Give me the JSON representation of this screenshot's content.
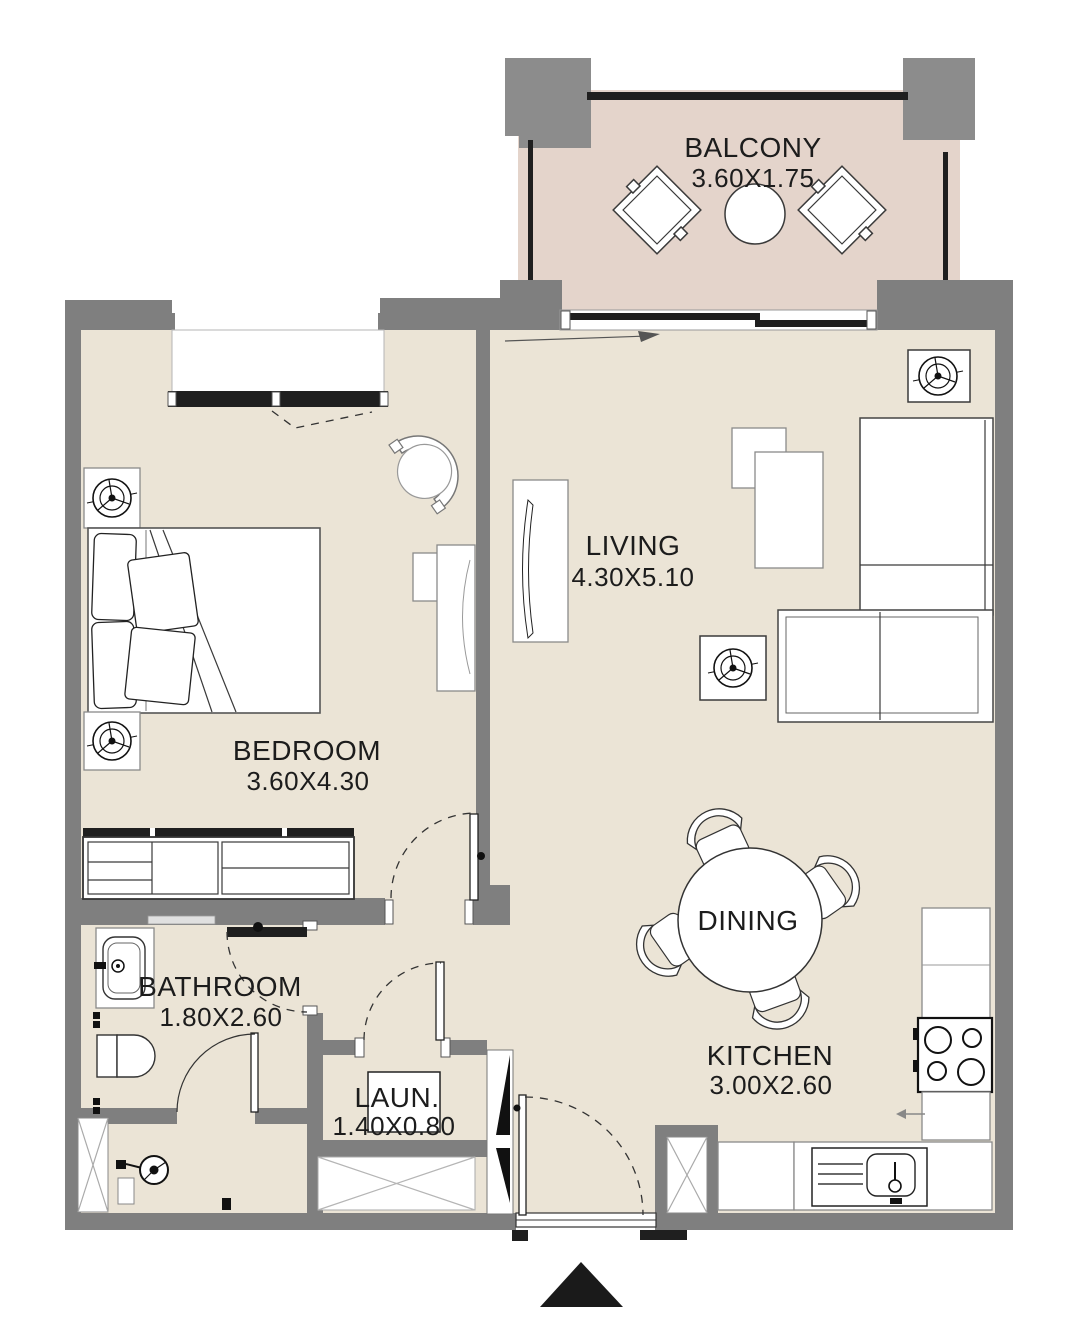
{
  "rooms": {
    "balcony": {
      "name": "BALCONY",
      "dims": "3.60X1.75"
    },
    "living": {
      "name": "LIVING",
      "dims": "4.30X5.10"
    },
    "bedroom": {
      "name": "BEDROOM",
      "dims": "3.60X4.30"
    },
    "bathroom": {
      "name": "BATHROOM",
      "dims": "1.80X2.60"
    },
    "laundry": {
      "name": "LAUN.",
      "dims": "1.40X0.80"
    },
    "dining": {
      "name": "DINING"
    },
    "kitchen": {
      "name": "KITCHEN",
      "dims": "3.00X2.60"
    }
  },
  "colors": {
    "wall": "#7f7f7f",
    "pillar": "#8c8c8c",
    "floor": "#ebe4d6",
    "balcony_floor": "#e4d4cb",
    "furniture_outline": "#3a3a3a",
    "window_frame": "#1f1f1f",
    "entry_marker": "#1a1a1a",
    "background": "#ffffff"
  },
  "icons": {
    "ceiling_light": "circle-fan-symbol",
    "stove": "four-burner-circles",
    "sink": "rounded-basin-with-tap",
    "shower": "spray-head-circle",
    "entry_marker": "solid-triangle",
    "shaft": "crossed-box"
  }
}
